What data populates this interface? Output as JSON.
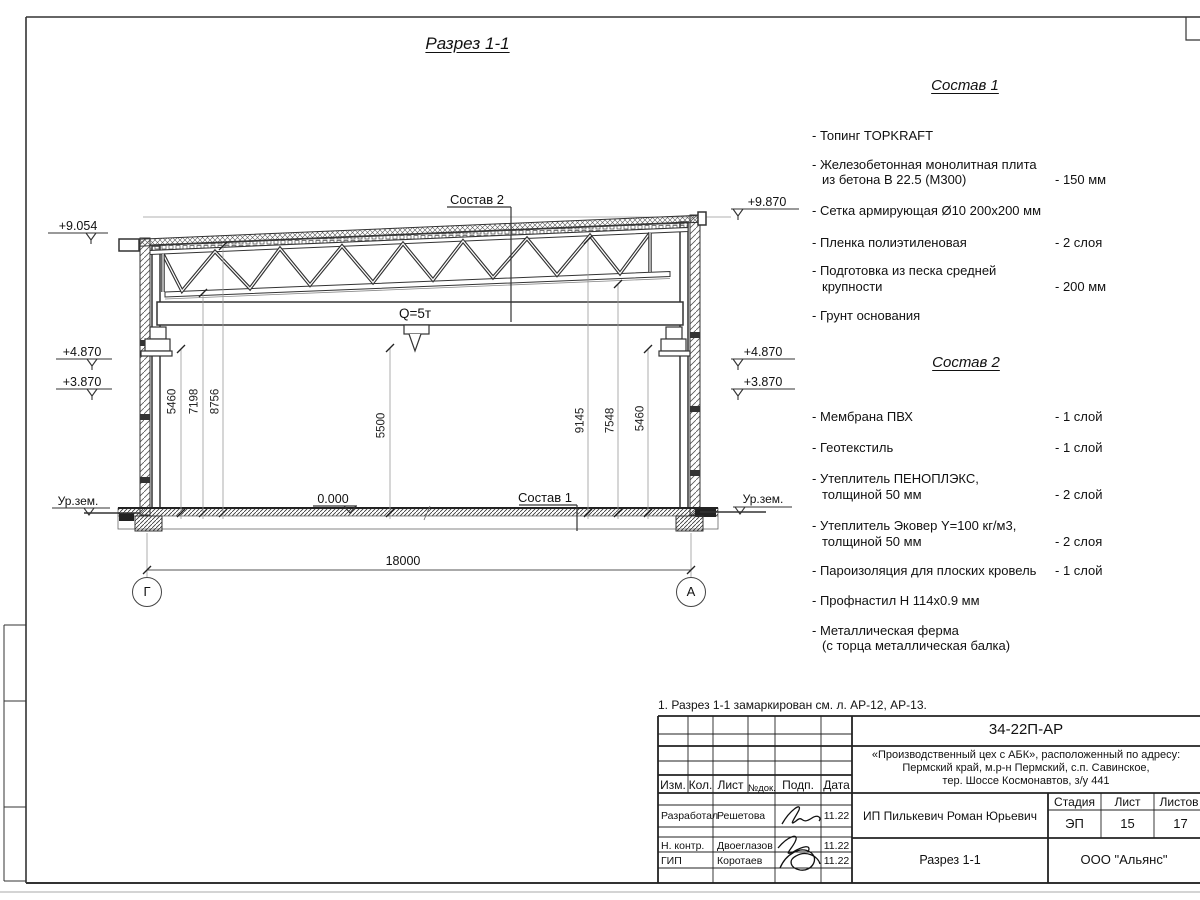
{
  "sheet": {
    "title": "Разрез 1-1",
    "note": "1. Разрез 1-1 замаркирован см. л. АР-12, АР-13."
  },
  "drawing": {
    "callout_sostav2": "Состав 2",
    "callout_sostav1": "Состав 1",
    "crane_label": "Q=5т",
    "zero_level": "0.000",
    "ground_label_left": "Ур.зем.",
    "ground_label_right": "Ур.зем.",
    "elev_left_top": "+9.054",
    "elev_right_top": "+9.870",
    "elev_left_1": "+4.870",
    "elev_left_2": "+3.870",
    "elev_right_1": "+4.870",
    "elev_right_2": "+3.870",
    "dims_left": [
      "5460",
      "7198",
      "8756"
    ],
    "dim_center": "5500",
    "dims_right": [
      "9145",
      "7548",
      "5460"
    ],
    "dim_span": "18000",
    "axis_left": "Г",
    "axis_right": "А"
  },
  "composition1": {
    "title": "Состав 1",
    "items": [
      {
        "line1": "- Топинг TOPKRAFT",
        "line2": "",
        "value": ""
      },
      {
        "line1": "- Железобетонная монолитная плита",
        "line2": "из бетона В 22.5 (М300)",
        "value": "- 150 мм"
      },
      {
        "line1": "- Сетка армирующая Ø10 200х200 мм",
        "line2": "",
        "value": ""
      },
      {
        "line1": "- Пленка полиэтиленовая",
        "line2": "",
        "value": "- 2 слоя"
      },
      {
        "line1": "- Подготовка из песка средней",
        "line2": "крупности",
        "value": "- 200 мм"
      },
      {
        "line1": "- Грунт основания",
        "line2": "",
        "value": ""
      }
    ]
  },
  "composition2": {
    "title": "Состав 2",
    "items": [
      {
        "line1": "- Мембрана ПВХ",
        "line2": "",
        "value": "- 1 слой"
      },
      {
        "line1": "- Геотекстиль",
        "line2": "",
        "value": "- 1 слой"
      },
      {
        "line1": "- Утеплитель ПЕНОПЛЭКС,",
        "line2": "толщиной 50 мм",
        "value": "- 2 слой"
      },
      {
        "line1": "- Утеплитель Эковер Y=100 кг/м3,",
        "line2": "толщиной 50 мм",
        "value": "- 2 слоя"
      },
      {
        "line1": "- Пароизоляция для плоских кровель",
        "line2": "",
        "value": "- 1 слой"
      },
      {
        "line1": "- Профнастил Н 114х0.9 мм",
        "line2": "",
        "value": ""
      },
      {
        "line1": "- Металлическая ферма",
        "line2": "(с торца металлическая балка)",
        "value": ""
      }
    ]
  },
  "title_block": {
    "doc_number": "34-22П-АР",
    "project_line1": "«Производственный цех с АБК», расположенный по адресу:",
    "project_line2": "Пермский край, м.р-н Пермский, с.п. Савинское,",
    "project_line3": "тер. Шоссе Космонавтов, з/у 441",
    "client": "ИП Пилькевич Роман Юрьевич",
    "sheet_title": "Разрез 1-1",
    "company": "ООО \"Альянс\"",
    "col_izm": "Изм.",
    "col_kol": "Кол.",
    "col_list": "Лист",
    "col_ndok": "№док.",
    "col_podp": "Подп.",
    "col_data": "Дата",
    "stage_label": "Стадия",
    "sheet_label": "Лист",
    "sheets_label": "Листов",
    "stage_value": "ЭП",
    "sheet_value": "15",
    "sheets_value": "17",
    "row1_role": "Разработал",
    "row1_name": "Решетова",
    "row1_date": "11.22",
    "row2_role": "Н. контр.",
    "row2_name": "Двоеглазов",
    "row2_date": "11.22",
    "row3_role": "ГИП",
    "row3_name": "Коротаев",
    "row3_date": "11.22"
  }
}
